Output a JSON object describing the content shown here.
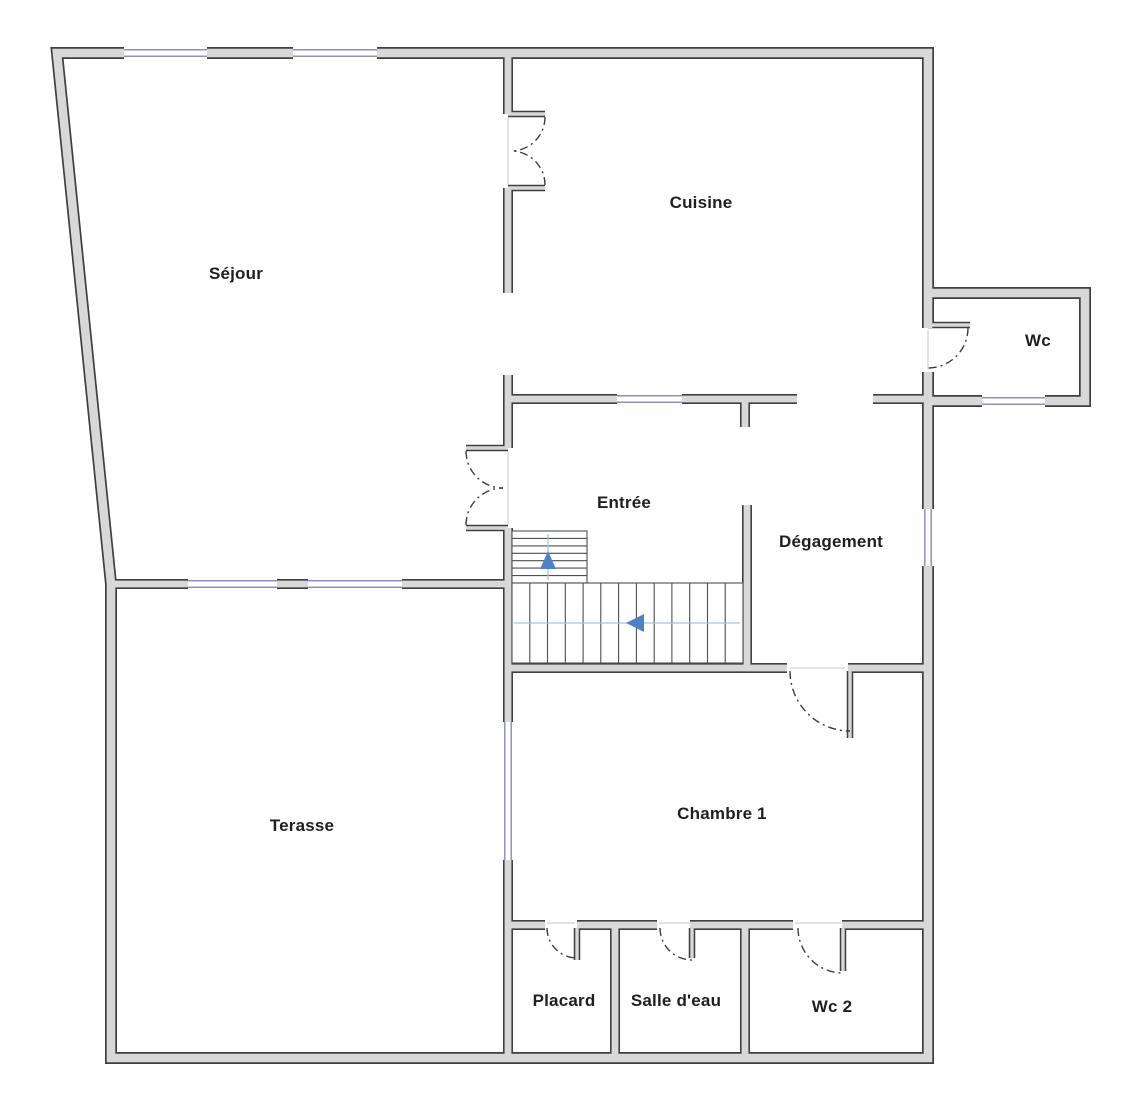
{
  "plan_title": "",
  "rooms": [
    {
      "id": "sejour",
      "label": "Séjour"
    },
    {
      "id": "cuisine",
      "label": "Cuisine"
    },
    {
      "id": "wc",
      "label": "Wc"
    },
    {
      "id": "entree",
      "label": "Entrée"
    },
    {
      "id": "degagement",
      "label": "Dégagement"
    },
    {
      "id": "terasse",
      "label": "Terasse"
    },
    {
      "id": "chambre1",
      "label": "Chambre 1"
    },
    {
      "id": "placard",
      "label": "Placard"
    },
    {
      "id": "salle-deau",
      "label": "Salle d'eau"
    },
    {
      "id": "wc2",
      "label": "Wc 2"
    }
  ],
  "colors": {
    "wall-fill": "#d8d8d8",
    "wall-outline": "#3f3f3f",
    "window": "#8f8fc4",
    "arrow": "#4d82c4",
    "guide": "#a9c1e2",
    "stair-line": "#4f4f4f",
    "door-arc": "#3c3c3c",
    "label": "#1f1f1f",
    "bg": "#ffffff"
  }
}
